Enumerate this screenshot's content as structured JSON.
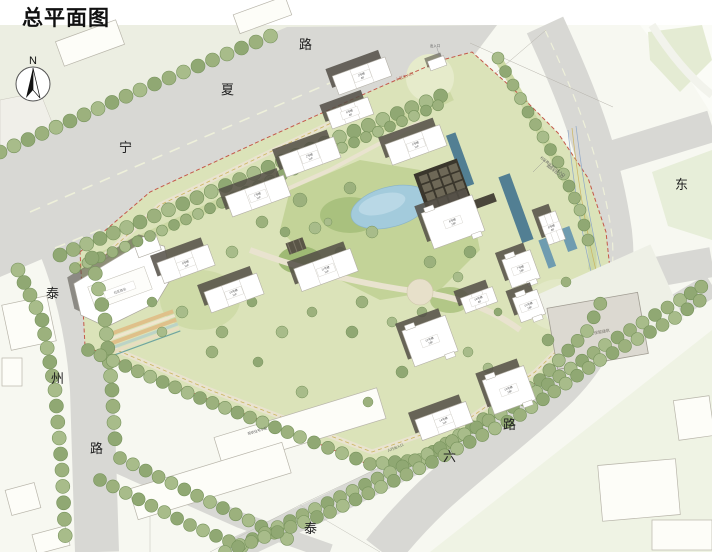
{
  "title": "总平面图",
  "compass": {
    "label": "N"
  },
  "roads": {
    "ningxia": [
      "宁",
      "夏",
      "路"
    ],
    "taizhou": [
      "泰",
      "州",
      "路"
    ],
    "east": [
      "东"
    ],
    "south": [
      "六",
      "路"
    ],
    "southwest": [
      "泰"
    ]
  },
  "annotations": {
    "entrance_commercial": "社区商业车行出入口",
    "entrance_fire": "消防车出入口",
    "entrance_main": "小区主入口",
    "entrance_top": "出入口",
    "entrance_south": "人行出入口",
    "existing_residential": "现状住宅小区",
    "existing_building": "现状保留建筑",
    "commercial_label": "社区商业"
  },
  "buildings": [
    {
      "name": "1号楼",
      "floors": "11F"
    },
    {
      "name": "2号楼",
      "floors": "11F"
    },
    {
      "name": "3号楼",
      "floors": "8F"
    },
    {
      "name": "4号楼",
      "floors": "8F"
    },
    {
      "name": "5号楼",
      "floors": "11F"
    },
    {
      "name": "6号楼",
      "floors": "18F"
    },
    {
      "name": "7号楼",
      "floors": "18F"
    },
    {
      "name": "8号楼",
      "floors": "8F"
    },
    {
      "name": "9号楼",
      "floors": "11F"
    },
    {
      "name": "10号楼",
      "floors": "11F"
    },
    {
      "name": "11号楼",
      "floors": "11F"
    },
    {
      "name": "12号楼",
      "floors": "18F"
    },
    {
      "name": "13号楼",
      "floors": "18F"
    },
    {
      "name": "14号楼",
      "floors": "11F"
    },
    {
      "name": "15号楼",
      "floors": "18F"
    },
    {
      "name": "16号楼",
      "floors": "8F"
    }
  ],
  "colors": {
    "road": "#d8d8d4",
    "tree": "#9cb17d",
    "site_green": "#dbe3b9",
    "water": "#a3cbdc",
    "boundary_red": "#c4584a",
    "shadow": "#524e45"
  }
}
